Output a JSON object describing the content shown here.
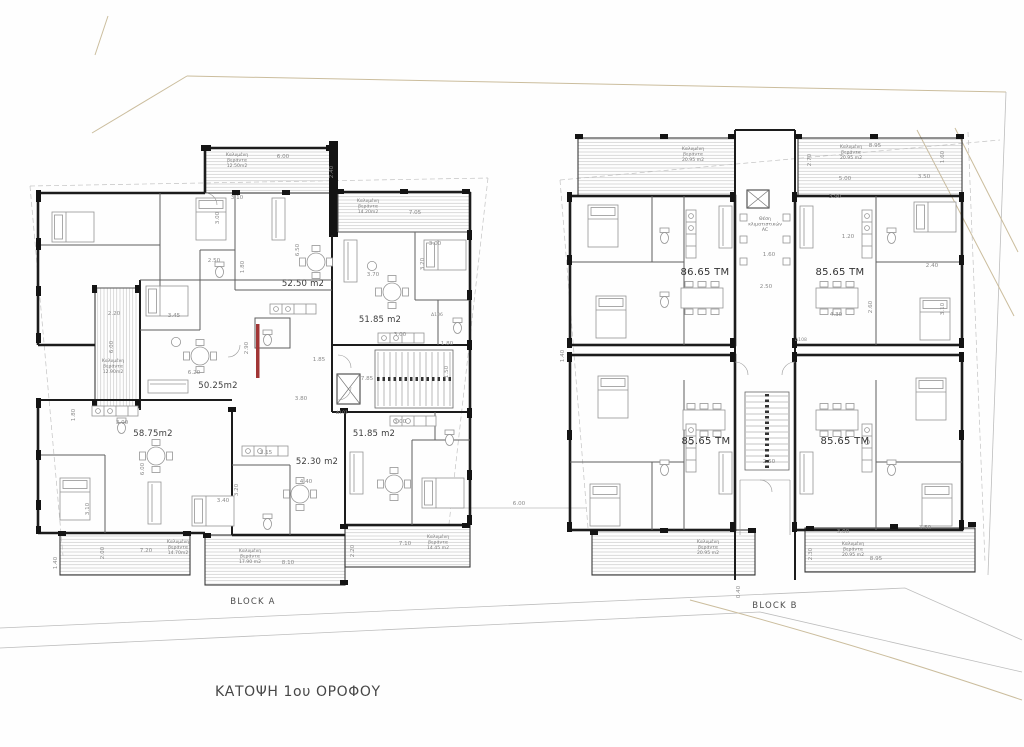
{
  "meta": {
    "title": "ΚΑΤΟΨΗ 1ου ΟΡΟΦΟΥ"
  },
  "blocks": {
    "a": {
      "label": "BLOCK A",
      "apartments": [
        {
          "area": "52.50 m2",
          "x": 303,
          "y": 286
        },
        {
          "area": "51.85 m2",
          "x": 380,
          "y": 322
        },
        {
          "area": "50.25m2",
          "x": 218,
          "y": 388
        },
        {
          "area": "58.75m2",
          "x": 153,
          "y": 436
        },
        {
          "area": "52.30 m2",
          "x": 317,
          "y": 464
        },
        {
          "area": "51.85 m2",
          "x": 374,
          "y": 436
        }
      ],
      "verandas": [
        {
          "name": "Καλυμένη βεράντα",
          "area": "12.50m2",
          "x": 237,
          "y": 156
        },
        {
          "name": "Καλυμένη βεράντα",
          "area": "14.20m2",
          "x": 368,
          "y": 202
        },
        {
          "name": "Καλυμένη βεράντα",
          "area": "12.90m2",
          "x": 113,
          "y": 362
        },
        {
          "name": "Καλυμένη βεράντα",
          "area": "14.70m2",
          "x": 178,
          "y": 543
        },
        {
          "name": "Καλυμένη βεράντα",
          "area": "17.90 m2",
          "x": 250,
          "y": 552
        },
        {
          "name": "Καλυμένη βεράντα",
          "area": "14.45 m2",
          "x": 438,
          "y": 538
        }
      ]
    },
    "b": {
      "label": "BLOCK B",
      "apartments": [
        {
          "area": "86.65 TM",
          "x": 705,
          "y": 275
        },
        {
          "area": "85.65 TM",
          "x": 840,
          "y": 275
        },
        {
          "area": "85.65 TM",
          "x": 706,
          "y": 444
        },
        {
          "area": "85.65 TM",
          "x": 845,
          "y": 444
        }
      ],
      "verandas": [
        {
          "name": "Καλυμένη βεράντα",
          "area": "20.95 m2",
          "x": 693,
          "y": 150
        },
        {
          "name": "Καλυμένη βεράντα",
          "area": "20.95 m2",
          "x": 851,
          "y": 148
        },
        {
          "name": "Καλυμένη βεράντα",
          "area": "20.95 m2",
          "x": 708,
          "y": 543
        },
        {
          "name": "Καλυμένη βεράντα",
          "area": "20.95 m2",
          "x": 853,
          "y": 545
        }
      ],
      "core": {
        "ac_label": "Θέση κλιματιστικών AC"
      }
    }
  },
  "unit_tags": [
    {
      "t": "Δ106",
      "x": 437,
      "y": 316
    },
    {
      "t": "Δ101",
      "x": 342,
      "y": 414
    },
    {
      "t": "Δ108",
      "x": 801,
      "y": 341
    }
  ],
  "dims": [
    {
      "t": "6.00",
      "x": 283,
      "y": 158
    },
    {
      "t": "3.10",
      "x": 237,
      "y": 199
    },
    {
      "t": "2.40",
      "x": 333,
      "y": 172,
      "r": 1
    },
    {
      "t": "7.05",
      "x": 415,
      "y": 214
    },
    {
      "t": "3.00",
      "x": 435,
      "y": 245
    },
    {
      "t": "3.20",
      "x": 424,
      "y": 264,
      "r": 1
    },
    {
      "t": "3.00",
      "x": 219,
      "y": 218,
      "r": 1
    },
    {
      "t": "1.80",
      "x": 244,
      "y": 267,
      "r": 1
    },
    {
      "t": "6.50",
      "x": 299,
      "y": 250,
      "r": 1
    },
    {
      "t": "3.70",
      "x": 373,
      "y": 276
    },
    {
      "t": "2.50",
      "x": 214,
      "y": 262
    },
    {
      "t": "3.45",
      "x": 174,
      "y": 317
    },
    {
      "t": "2.20",
      "x": 114,
      "y": 315
    },
    {
      "t": "6.00",
      "x": 113,
      "y": 347,
      "r": 1
    },
    {
      "t": "2.90",
      "x": 248,
      "y": 348,
      "r": 1
    },
    {
      "t": "6.20",
      "x": 194,
      "y": 374
    },
    {
      "t": "1.85",
      "x": 319,
      "y": 361
    },
    {
      "t": "7.85",
      "x": 367,
      "y": 380
    },
    {
      "t": "3.80",
      "x": 301,
      "y": 400
    },
    {
      "t": "3.00",
      "x": 400,
      "y": 336
    },
    {
      "t": "1.80",
      "x": 447,
      "y": 345
    },
    {
      "t": "1.50",
      "x": 448,
      "y": 372,
      "r": 1
    },
    {
      "t": "3.00",
      "x": 400,
      "y": 423
    },
    {
      "t": "3.00",
      "x": 122,
      "y": 424
    },
    {
      "t": "1.80",
      "x": 75,
      "y": 415,
      "r": 1
    },
    {
      "t": "3.15",
      "x": 266,
      "y": 454
    },
    {
      "t": "4.40",
      "x": 306,
      "y": 483
    },
    {
      "t": "3.20",
      "x": 238,
      "y": 490,
      "r": 1
    },
    {
      "t": "3.40",
      "x": 223,
      "y": 502
    },
    {
      "t": "3.10",
      "x": 89,
      "y": 509,
      "r": 1
    },
    {
      "t": "6.00",
      "x": 144,
      "y": 469,
      "r": 1
    },
    {
      "t": "7.20",
      "x": 146,
      "y": 552
    },
    {
      "t": "8.10",
      "x": 288,
      "y": 564
    },
    {
      "t": "7.10",
      "x": 405,
      "y": 545
    },
    {
      "t": "2.00",
      "x": 104,
      "y": 553,
      "r": 1
    },
    {
      "t": "2.20",
      "x": 354,
      "y": 551,
      "r": 1
    },
    {
      "t": "1.40",
      "x": 57,
      "y": 563,
      "r": 1
    },
    {
      "t": "6.00",
      "x": 519,
      "y": 505
    },
    {
      "t": "8.95",
      "x": 875,
      "y": 147
    },
    {
      "t": "2.70",
      "x": 811,
      "y": 160,
      "r": 1
    },
    {
      "t": "1.60",
      "x": 944,
      "y": 157,
      "r": 1
    },
    {
      "t": "5.00",
      "x": 845,
      "y": 180
    },
    {
      "t": "3.50",
      "x": 924,
      "y": 178
    },
    {
      "t": "3.90",
      "x": 835,
      "y": 198
    },
    {
      "t": "1.20",
      "x": 848,
      "y": 238
    },
    {
      "t": "2.40",
      "x": 932,
      "y": 267
    },
    {
      "t": "2.60",
      "x": 872,
      "y": 307,
      "r": 1
    },
    {
      "t": "3.10",
      "x": 944,
      "y": 309,
      "r": 1
    },
    {
      "t": "4.30",
      "x": 836,
      "y": 316
    },
    {
      "t": "1.60",
      "x": 769,
      "y": 256
    },
    {
      "t": "2.50",
      "x": 766,
      "y": 288
    },
    {
      "t": "2.50",
      "x": 769,
      "y": 463
    },
    {
      "t": "1.40",
      "x": 564,
      "y": 356,
      "r": 1
    },
    {
      "t": "3.50",
      "x": 925,
      "y": 529
    },
    {
      "t": "3.00",
      "x": 843,
      "y": 533
    },
    {
      "t": "8.95",
      "x": 876,
      "y": 560
    },
    {
      "t": "2.30",
      "x": 812,
      "y": 554,
      "r": 1
    },
    {
      "t": "0.40",
      "x": 740,
      "y": 592,
      "r": 1
    }
  ]
}
